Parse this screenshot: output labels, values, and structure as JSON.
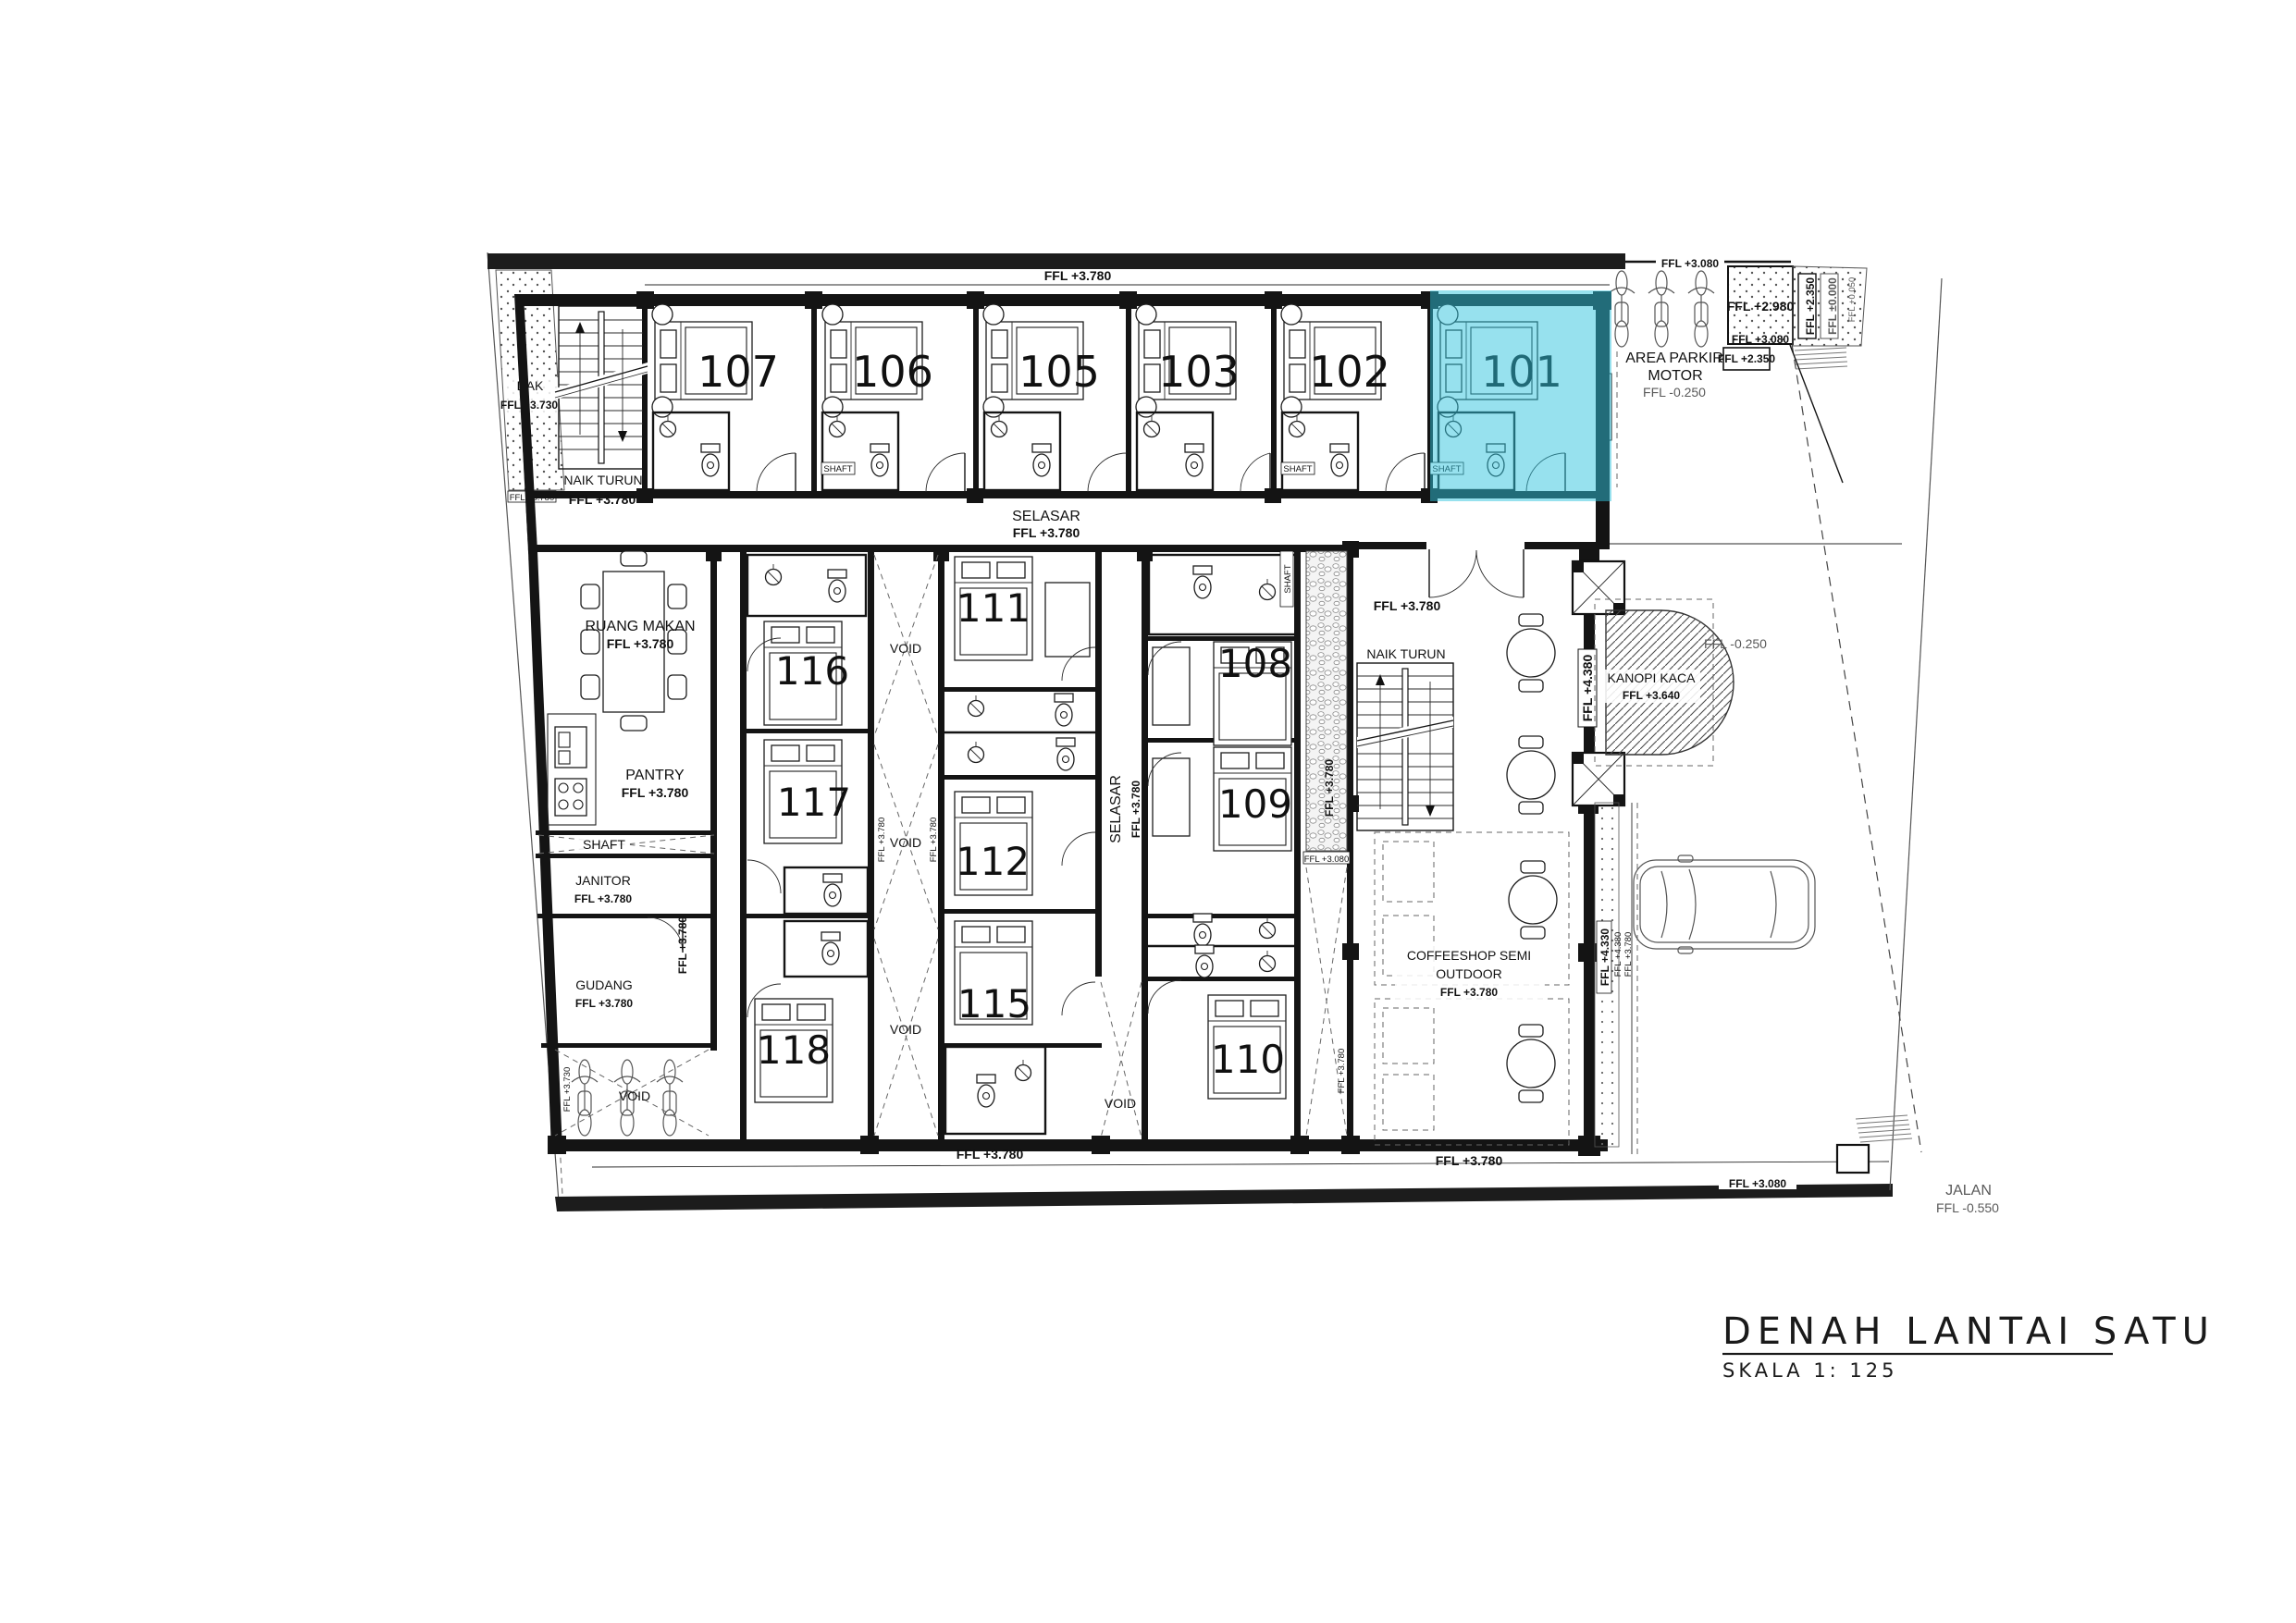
{
  "title": {
    "main": "DENAH LANTAI SATU",
    "scale": "SKALA 1: 125"
  },
  "rooms": {
    "top": [
      "107",
      "106",
      "105",
      "103",
      "102",
      "101"
    ],
    "left_column": [
      "116",
      "117",
      "118"
    ],
    "center_column": [
      "111",
      "112",
      "115"
    ],
    "right_column": [
      "108",
      "109",
      "110"
    ]
  },
  "highlight": {
    "room": "101",
    "color": "#2fc4de"
  },
  "areas": {
    "dak": {
      "label": "DAK",
      "ffl": "FFL +3.730"
    },
    "stairs_top": {
      "label": "NAIK TURUN",
      "ffl": "FFL +3.780"
    },
    "selasar": {
      "label": "SELASAR",
      "ffl": "FFL +3.780"
    },
    "ruang_makan": {
      "label": "RUANG MAKAN",
      "ffl": "FFL +3.780"
    },
    "pantry": {
      "label": "PANTRY",
      "ffl": "FFL +3.780"
    },
    "shaft": {
      "label": "SHAFT"
    },
    "janitor": {
      "label": "JANITOR",
      "ffl": "FFL +3.780"
    },
    "gudang": {
      "label": "GUDANG",
      "ffl": "FFL +3.780"
    },
    "void": {
      "label": "VOID"
    },
    "lobby": {
      "ffl": "FFL +3.780",
      "stairs": "NAIK TURUN"
    },
    "coffeeshop": {
      "line1": "COFFEESHOP SEMI",
      "line2": "OUTDOOR",
      "ffl": "FFL +3.780"
    },
    "kanopi": {
      "label": "KANOPI KACA",
      "ffl": "FFL +3.640"
    },
    "parkir_motor": {
      "line1": "AREA PARKIR",
      "line2": "MOTOR",
      "ffl": "FFL -0.250"
    },
    "jalan": {
      "label": "JALAN",
      "ffl": "FFL -0.550"
    }
  },
  "levels": {
    "ffl_3780": "FFL +3.780",
    "ffl_3730": "FFL +3.730",
    "ffl_3080": "FFL +3.080",
    "ffl_2980": "FFL +2.980",
    "ffl_2350": "FFL +2.350",
    "ffl_0000": "FFL ±0.000",
    "ffl_0050": "FFL +0.050",
    "ffl_4380": "FFL +4.380",
    "ffl_4330": "FFL +4.330",
    "ffl_m0250": "FFL -0.250",
    "ffl_m0550": "FFL -0.550"
  }
}
